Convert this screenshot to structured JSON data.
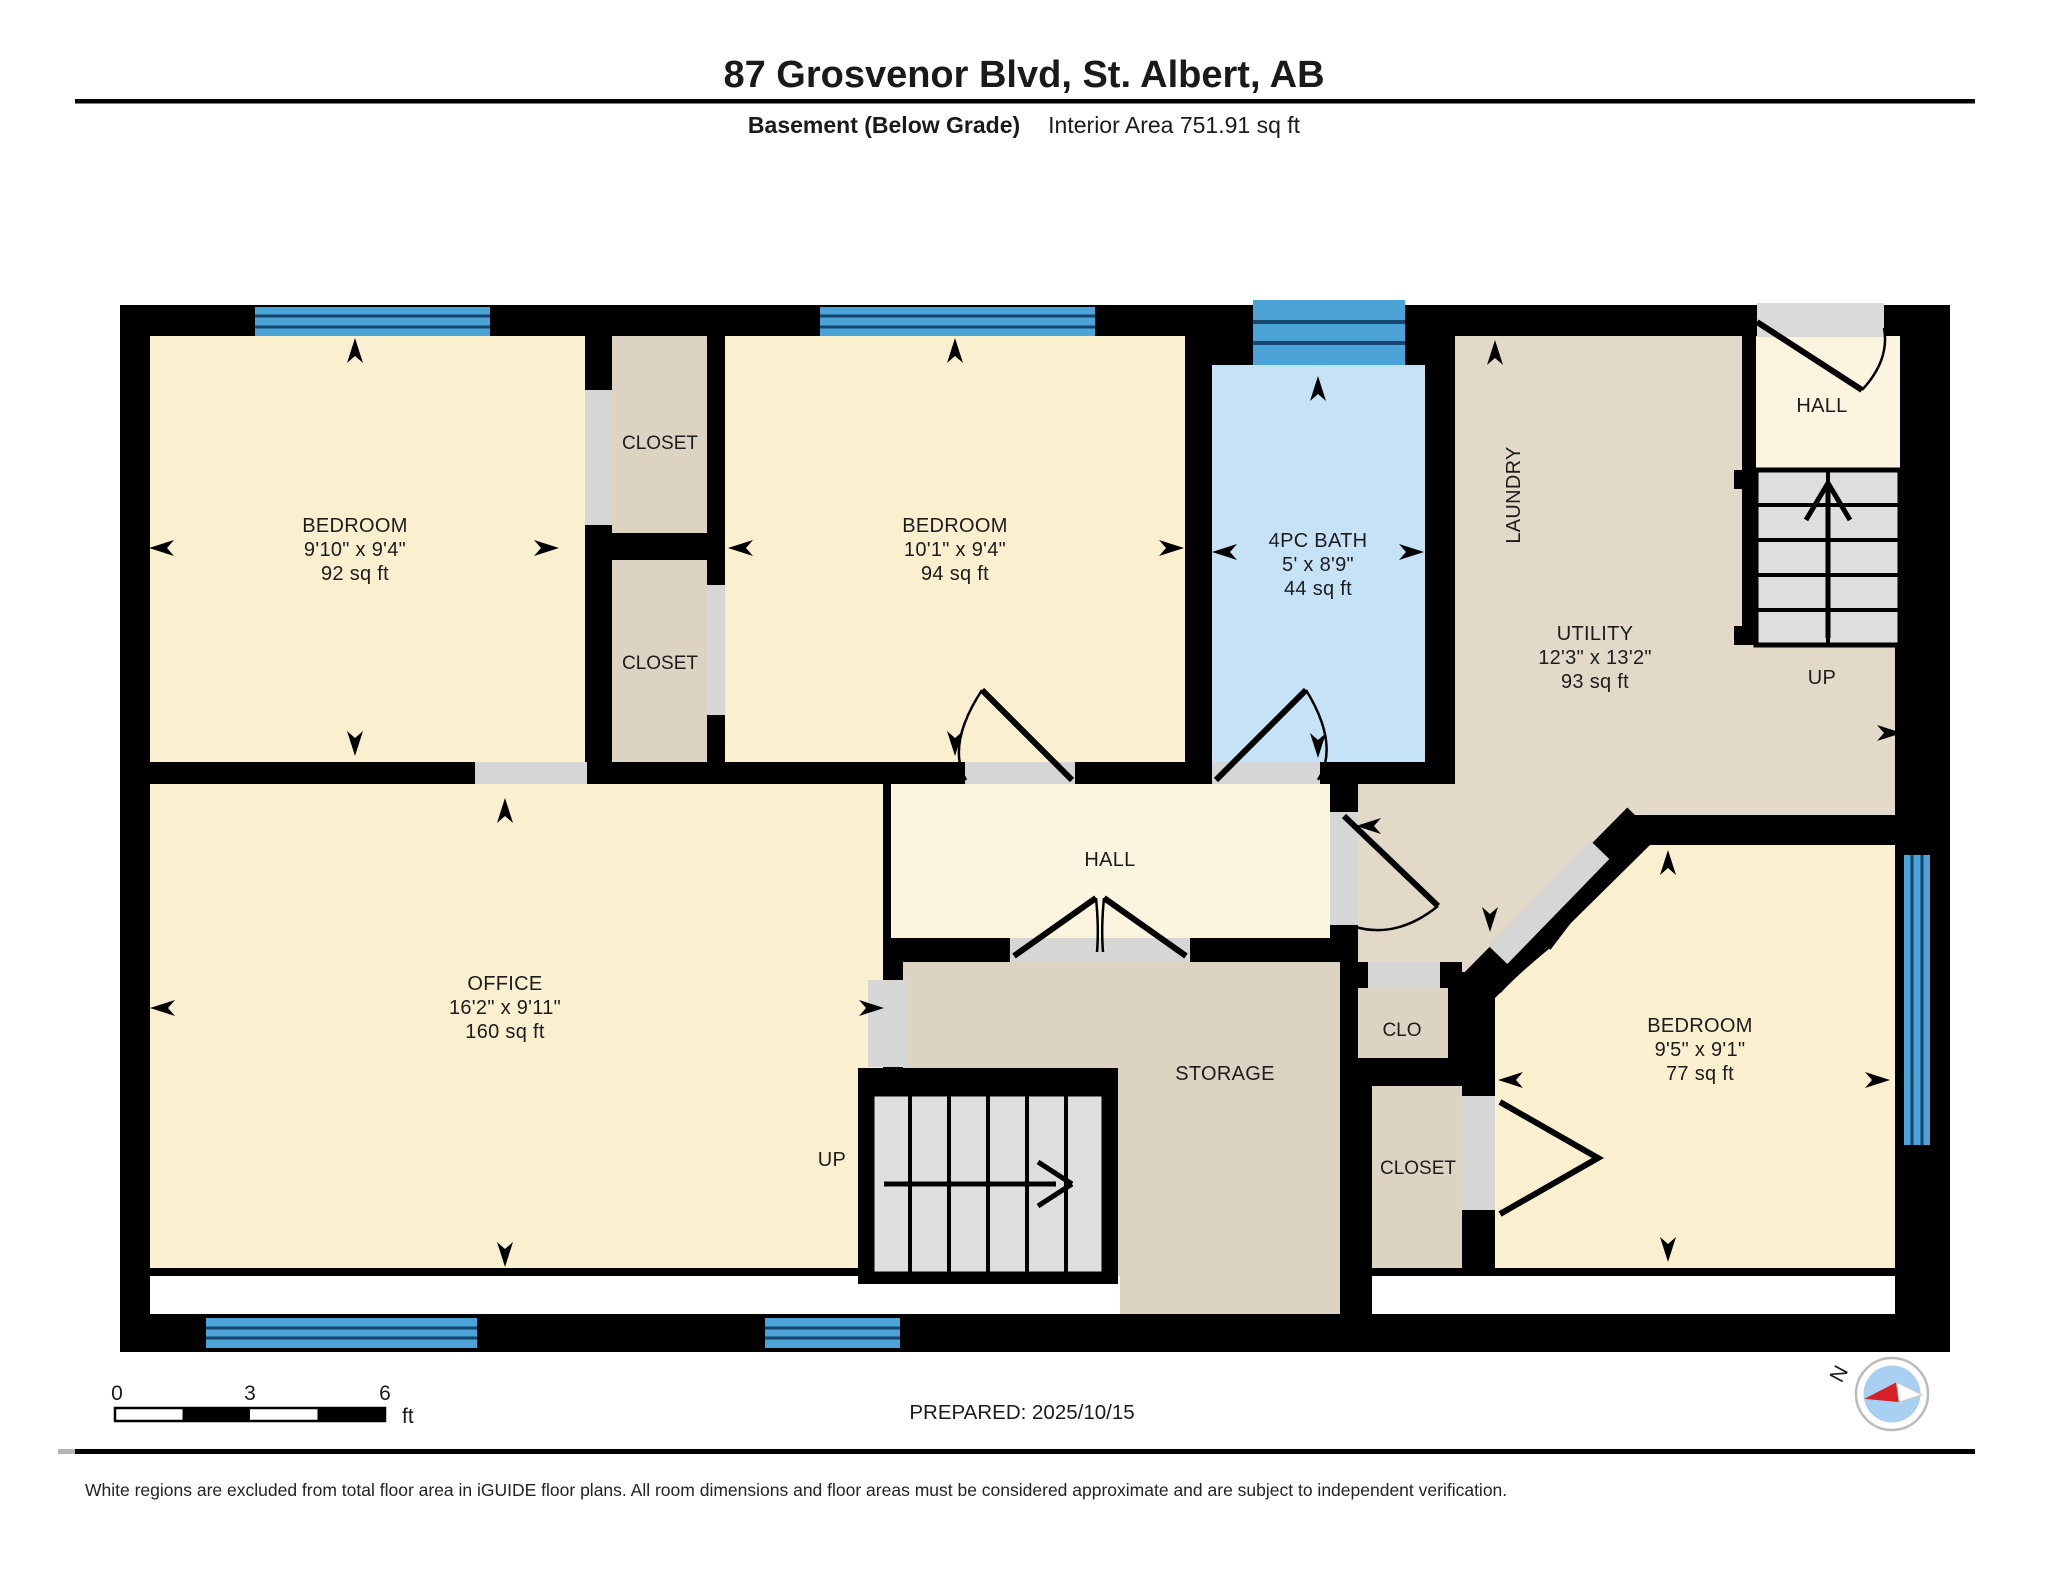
{
  "header": {
    "title": "87 Grosvenor Blvd, St. Albert, AB",
    "floor_label": "Basement (Below Grade)",
    "area_label": "Interior Area 751.91 sq ft"
  },
  "rooms": {
    "bedroom1": {
      "name": "BEDROOM",
      "dims": "9'10\" x 9'4\"",
      "area": "92 sq ft"
    },
    "closet1": {
      "name": "CLOSET"
    },
    "closet2": {
      "name": "CLOSET"
    },
    "bedroom2": {
      "name": "BEDROOM",
      "dims": "10'1\" x 9'4\"",
      "area": "94 sq ft"
    },
    "bath": {
      "name": "4PC BATH",
      "dims": "5' x 8'9\"",
      "area": "44 sq ft"
    },
    "laundry": {
      "name": "LAUNDRY"
    },
    "utility": {
      "name": "UTILITY",
      "dims": "12'3\" x 13'2\"",
      "area": "93 sq ft"
    },
    "hall_upper": {
      "name": "HALL"
    },
    "office": {
      "name": "OFFICE",
      "dims": "16'2\" x 9'11\"",
      "area": "160 sq ft"
    },
    "hall": {
      "name": "HALL"
    },
    "storage": {
      "name": "STORAGE"
    },
    "clo": {
      "name": "CLO"
    },
    "closet3": {
      "name": "CLOSET"
    },
    "bedroom3": {
      "name": "BEDROOM",
      "dims": "9'5\" x 9'1\"",
      "area": "77 sq ft"
    }
  },
  "stairs": {
    "up_upper": "UP",
    "up_lower": "UP"
  },
  "scale_bar": {
    "tick_0": "0",
    "tick_3": "3",
    "tick_6": "6",
    "unit": "ft"
  },
  "compass": {
    "north_label": "N"
  },
  "footer": {
    "prepared": "PREPARED: 2025/10/15",
    "disclaimer": "White regions are excluded from total floor area in iGUIDE floor plans. All room dimensions and floor areas must be considered approximate and are subject to independent verification."
  },
  "colors": {
    "wall": "#000000",
    "room_cream": "#FAEFCF",
    "hall_cream": "#FBF5DF",
    "closet_tan": "#DDD3C3",
    "utility_tan": "#E3D9C8",
    "bath_blue": "#C5E2F7",
    "window_blue": "#4CA3D8",
    "window_line": "#16466F",
    "stair_gray": "#DEDEDE",
    "door_gap_gray": "#D6D6D6"
  }
}
